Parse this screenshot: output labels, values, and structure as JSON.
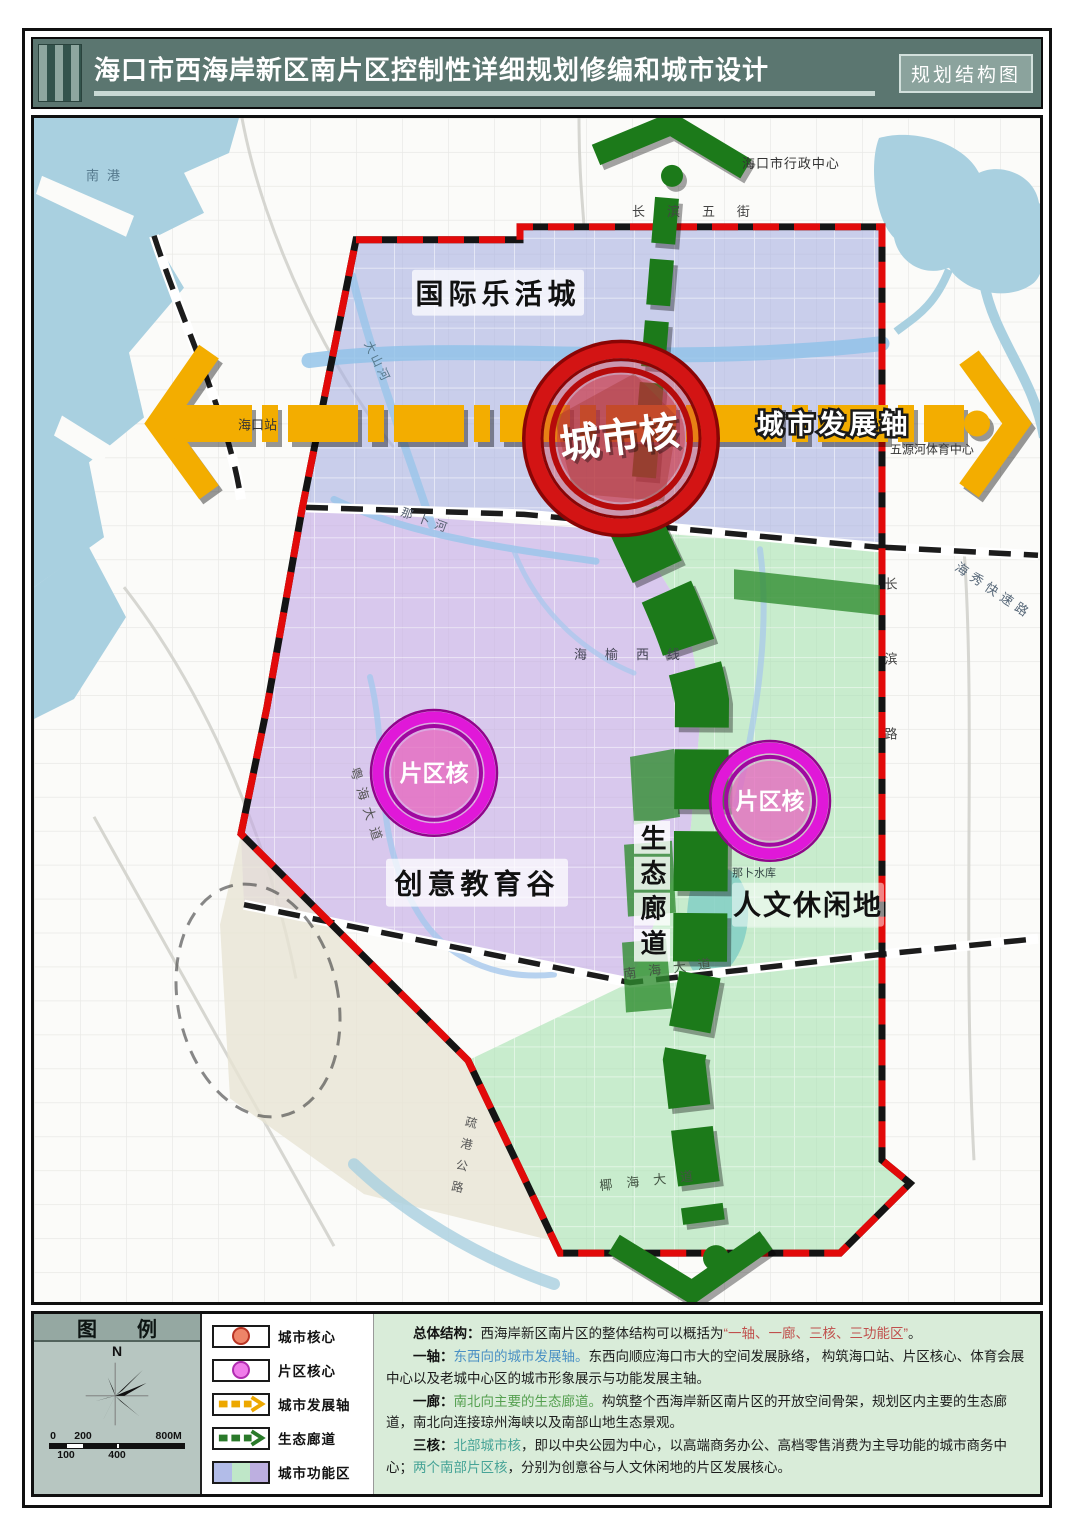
{
  "header": {
    "title": "海口市西海岸新区南片区控制性详细规划修编和城市设计",
    "badge": "规划结构图"
  },
  "map": {
    "zones": {
      "blue": "国际乐活城",
      "purple": "创意教育谷",
      "green": "人文休闲地"
    },
    "cores": {
      "city_core": "城市核",
      "district_core_left": "片区核",
      "district_core_right": "片区核"
    },
    "axis": {
      "label": "城市发展轴"
    },
    "corridor": {
      "label": "生态廊道"
    },
    "places": {
      "nangang": "南港",
      "admin_center": "海口市行政中心",
      "haikou_station": "海口站",
      "wuyuanhe_sports": "五源河体育中心",
      "nabu_reservoir": "那卜水库"
    },
    "roads": {
      "changbin_wujie": "长滨五街",
      "changbin_lu": "长滨路",
      "haixiu_expressway": "海秀快速路",
      "haiyu_west_line": "海榆西线",
      "yuehai_avenue": "粤海大道",
      "nanhai_avenue": "南海大道",
      "yehai_avenue": "椰海大道",
      "shugang_highway": "疏港公路"
    },
    "rivers": {
      "dashan_river": "大山河",
      "nabu_river": "那卜河"
    },
    "colors": {
      "city_core_red": "#d31414",
      "district_core_magenta": "#e018d8",
      "axis_yellow": "#f3ad00",
      "corridor_green": "#1c7a1a",
      "zone_blue": "#a9b2e2",
      "zone_purple": "#c2a6e4",
      "zone_green": "#a8e2b2",
      "boundary_red": "#e20a0a"
    }
  },
  "legend": {
    "title": "图例",
    "north": "N",
    "scale": {
      "top": [
        "0",
        "200",
        "800M"
      ],
      "bottom": [
        "100",
        "400"
      ]
    },
    "items": [
      {
        "label": "城市核心"
      },
      {
        "label": "片区核心"
      },
      {
        "label": "城市发展轴"
      },
      {
        "label": "生态廊道"
      },
      {
        "label": "城市功能区"
      }
    ]
  },
  "notes": {
    "p1": {
      "lead": "总体结构：",
      "a": "西海岸新区南片区的整体结构可以概括为",
      "b": "“一轴、一廊、三核、三功能区”",
      "c": "。"
    },
    "p2": {
      "lead": "一轴：",
      "a": "东西向的城市发展轴。",
      "b": "东西向顺应海口市大的空间发展脉络， 构筑海口站、片区核心、体育会展中心以及老城中心区的城市形象展示与功能发展主轴。"
    },
    "p3": {
      "lead": "一廊：",
      "a": "南北向主要的生态廊道。",
      "b": "构筑整个西海岸新区南片区的开放空间骨架，规划区内主要的生态廊道，南北向连接琼州海峡以及南部山地生态景观。"
    },
    "p4": {
      "lead": "三核：",
      "a": "北部城市核",
      "b": "，即以中央公园为中心，以高端商务办公、高档零售消费为主导功能的城市商务中心；",
      "c": "两个南部片区核",
      "d": "，分别为创意谷与人文休闲地的片区发展核心。"
    }
  }
}
